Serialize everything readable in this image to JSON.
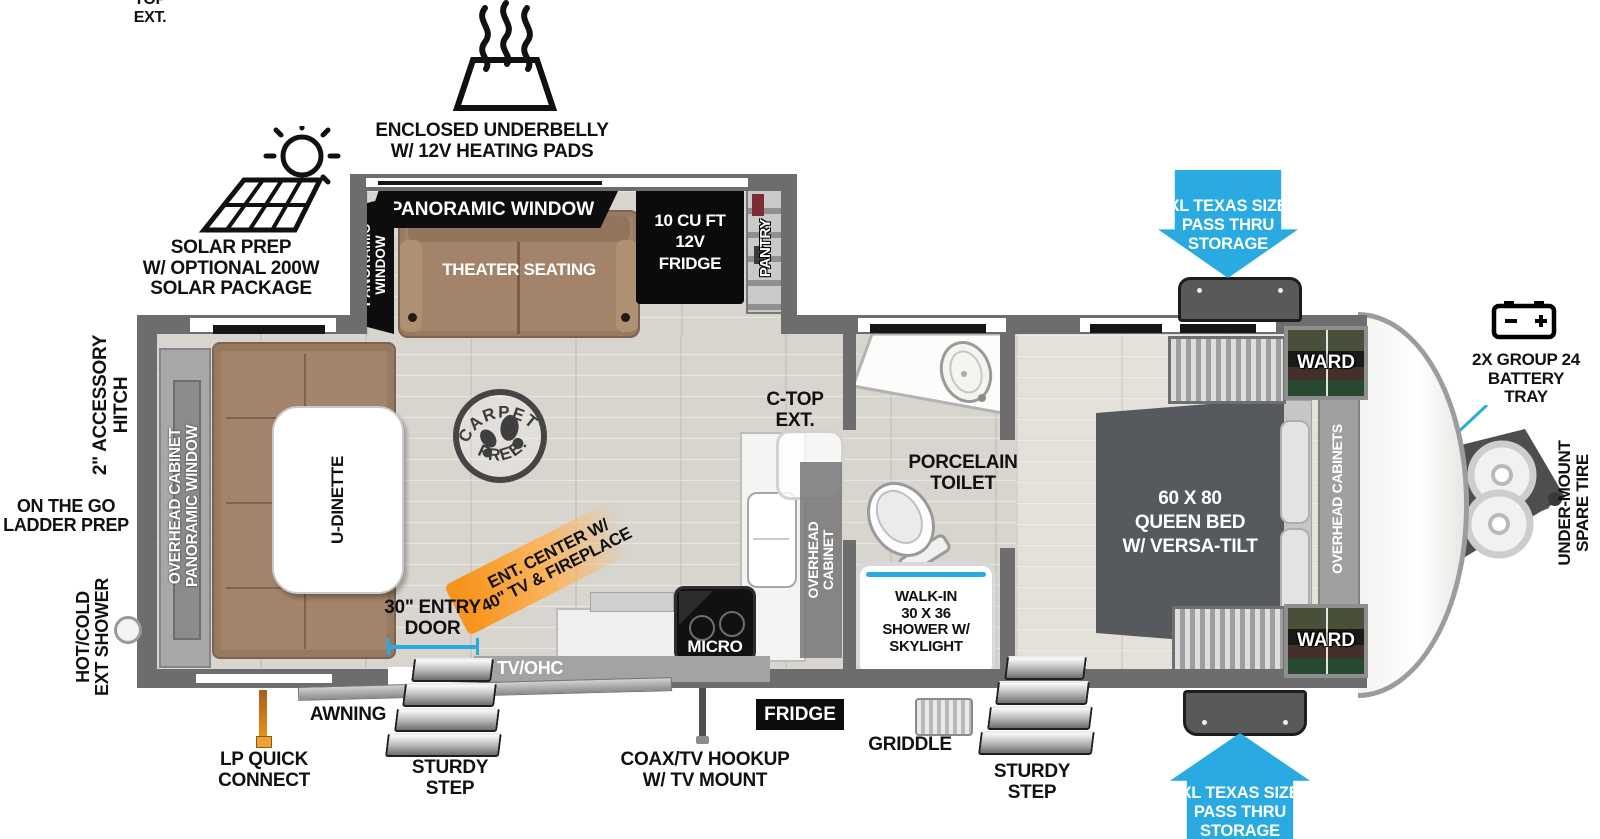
{
  "colors": {
    "accent_blue": "#29ABE2",
    "highlight_orange": "#F7941D",
    "wall_gray": "#6D6D6D",
    "furniture_brown": "#A3846A",
    "bed_gray": "#56595D"
  },
  "exterior_callouts": {
    "underbelly": "ENCLOSED UNDERBELLY\nW/ 12V HEATING PADS",
    "solar": "SOLAR PREP\nW/ OPTIONAL 200W\nSOLAR PACKAGE",
    "pass_thru_storage": "XL TEXAS SIZE\nPASS THRU\nSTORAGE",
    "battery_tray": "2X GROUP 24\nBATTERY\nTRAY",
    "spare_tire": "UNDER-MOUNT\nSPARE TIRE",
    "accessory_hitch": "2\" ACCESSORY\nHITCH",
    "ladder_prep": "ON THE GO\nLADDER PREP",
    "ext_shower": "HOT/COLD\nEXT SHOWER",
    "lp_quick_connect": "LP QUICK\nCONNECT",
    "awning": "AWNING",
    "sturdy_step": "STURDY\nSTEP",
    "coax_tv": "COAX/TV HOOKUP\nW/ TV MOUNT",
    "griddle": "GRIDDLE",
    "entry_door": "30\" ENTRY\nDOOR",
    "ent_center": "ENT. CENTER W/\n40\" TV & FIREPLACE",
    "ctop_ext": "C-TOP\nEXT.",
    "porcelain_toilet": "PORCELAIN\nTOILET"
  },
  "interior_labels": {
    "panoramic_window": "PANORAMIC WINDOW",
    "panoramic_window_stacked": "PANORAMIC\nWINDOW",
    "theater_seating": "THEATER SEATING",
    "fridge_12v": "10 CU FT\n12V\nFRIDGE",
    "pantry": "PANTRY",
    "queen_bed": "60 X 80\nQUEEN BED\nW/ VERSA-TILT",
    "ward": "WARD",
    "overhead_cabinets": "OVERHEAD CABINETS",
    "overhead_cabinet": "OVERHEAD\nCABINET",
    "micro": "MICRO",
    "fridge": "FRIDGE",
    "tv_ohc": "TV/OHC",
    "shower": "WALK-IN\n30 X 36\nSHOWER W/\nSKYLIGHT",
    "u_dinette": "U-DINETTE",
    "rear_storage": "OVERHEAD CABINET\nPANORAMIC WINDOW"
  },
  "stamp": {
    "top": "CARPET",
    "bottom": "FREE!"
  }
}
